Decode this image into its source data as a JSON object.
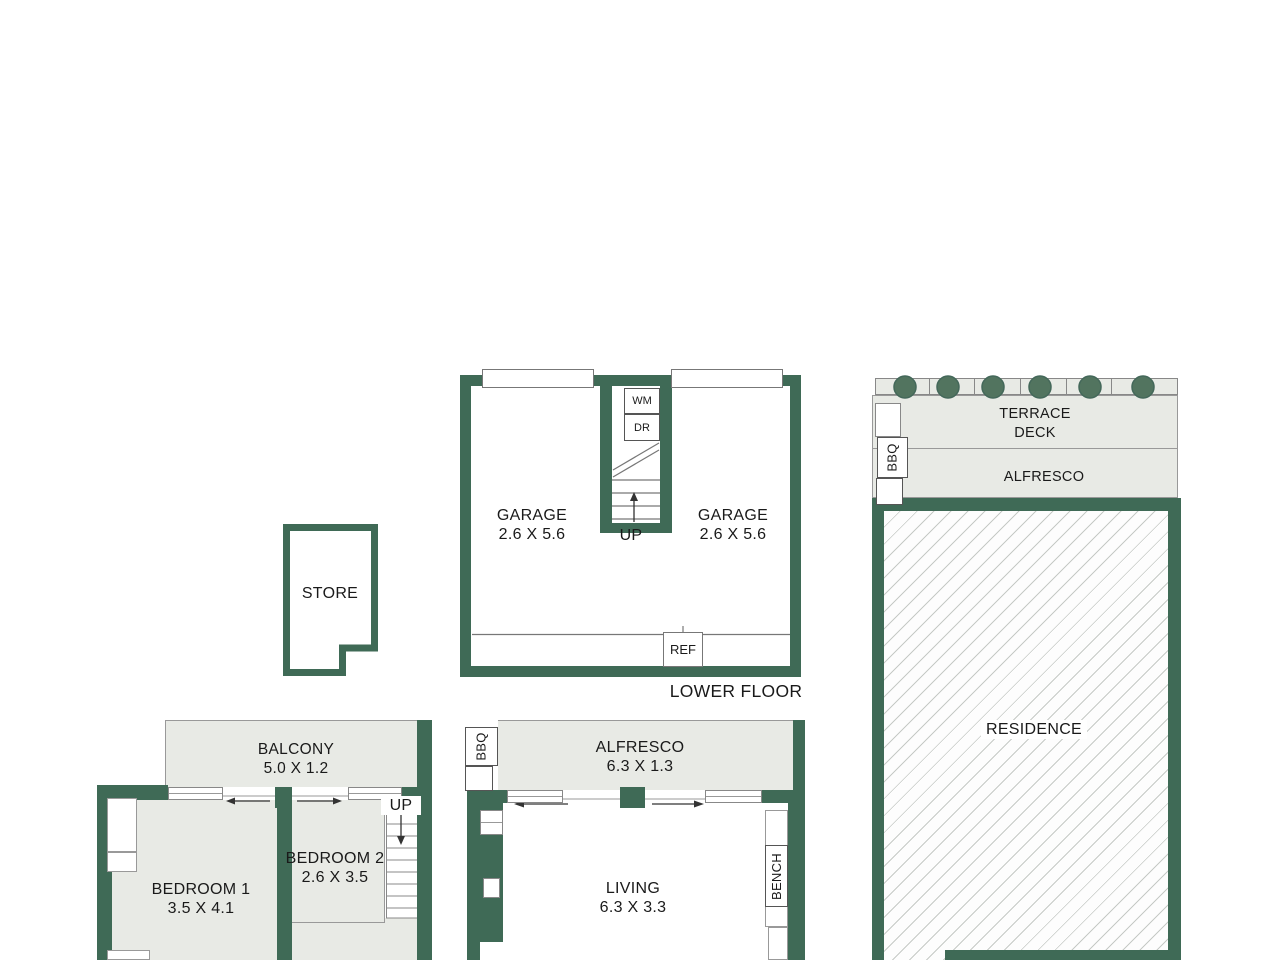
{
  "title": "Floor plan",
  "colors": {
    "wall_green": "#3f6a56",
    "room_fill": "#e8eae5",
    "plant_green": "#52745f",
    "hatch_line": "#c6cac6"
  },
  "rooms": {
    "garage_left": {
      "name": "GARAGE",
      "dims": "2.6 X 5.6"
    },
    "garage_right": {
      "name": "GARAGE",
      "dims": "2.6 X 5.6"
    },
    "store": {
      "name": "STORE"
    },
    "balcony": {
      "name": "BALCONY",
      "dims": "5.0 X 1.2"
    },
    "bedroom1": {
      "name": "BEDROOM 1",
      "dims": "3.5 X 4.1"
    },
    "bedroom2": {
      "name": "BEDROOM 2",
      "dims": "2.6 X 3.5"
    },
    "alfresco_main": {
      "name": "ALFRESCO",
      "dims": "6.3 X 1.3"
    },
    "living": {
      "name": "LIVING",
      "dims": "6.3 X 3.3"
    },
    "terrace": {
      "line1": "TERRACE",
      "line2": "DECK"
    },
    "alfresco_side": {
      "name": "ALFRESCO"
    },
    "residence": {
      "name": "RESIDENCE"
    }
  },
  "labels": {
    "floor_title": "LOWER FLOOR",
    "up_garage": "UP",
    "up_bedroom": "UP",
    "washer": "WM",
    "dryer": "DR",
    "fridge": "REF",
    "bbq_side": "BBQ",
    "bbq_main": "BBQ",
    "bench": "BENCH"
  }
}
